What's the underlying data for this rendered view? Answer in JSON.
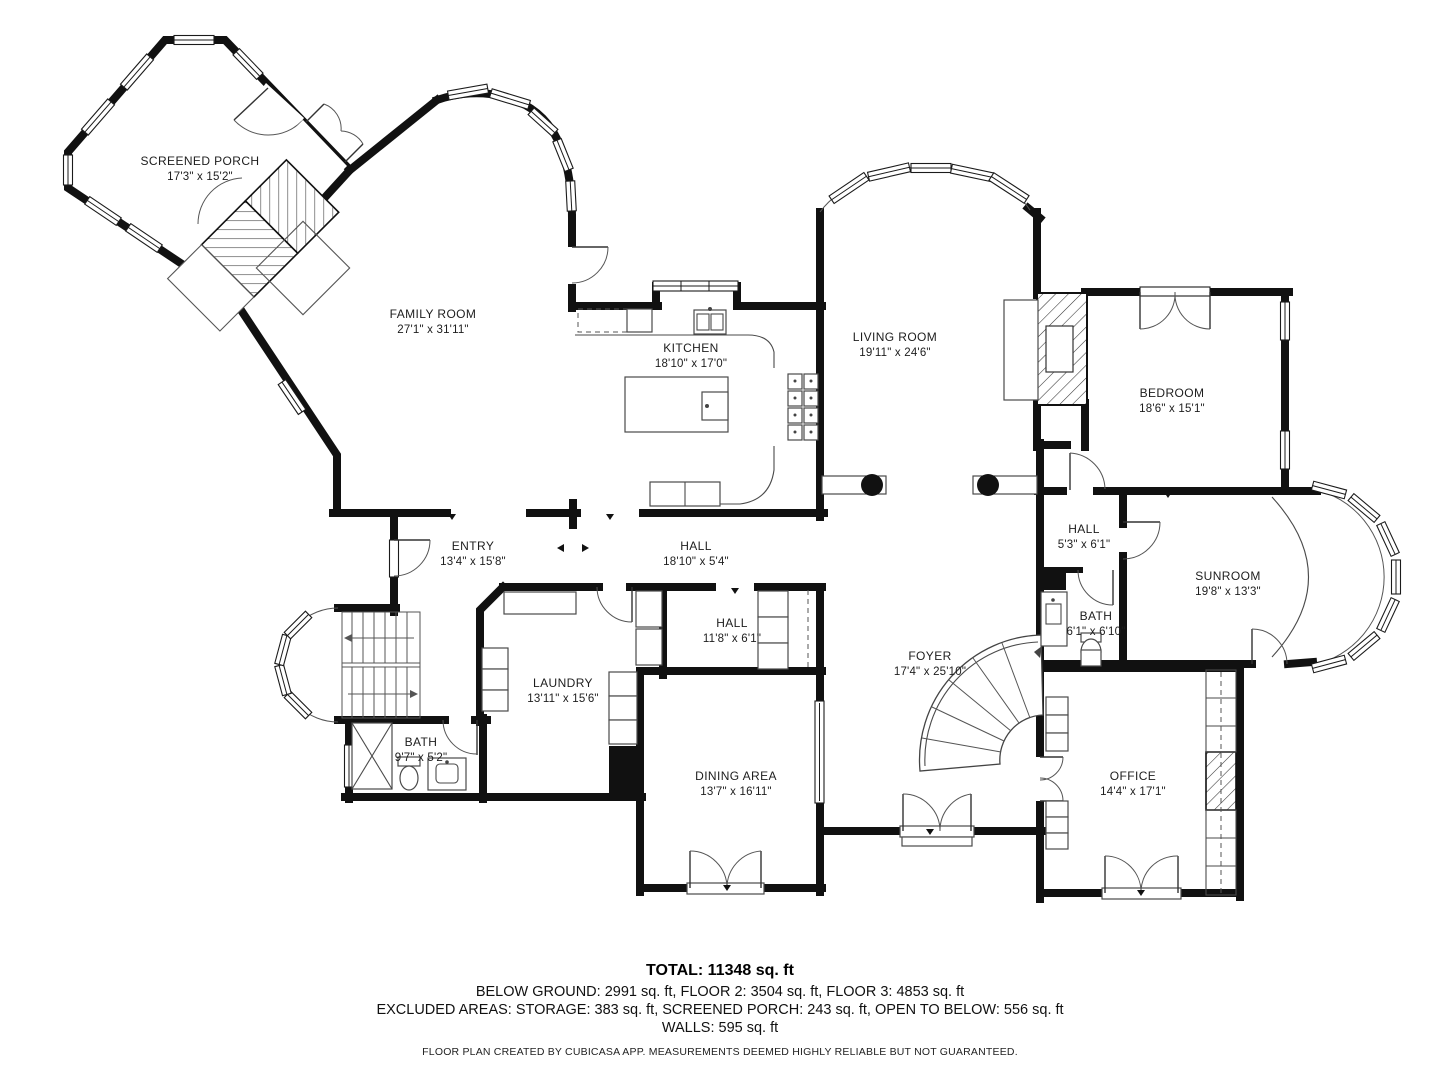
{
  "rooms": [
    {
      "name": "SCREENED PORCH",
      "dims": "17'3\" x 15'2\""
    },
    {
      "name": "FAMILY ROOM",
      "dims": "27'1\" x 31'11\""
    },
    {
      "name": "KITCHEN",
      "dims": "18'10\" x 17'0\""
    },
    {
      "name": "LIVING ROOM",
      "dims": "19'11\" x 24'6\""
    },
    {
      "name": "BEDROOM",
      "dims": "18'6\" x 15'1\""
    },
    {
      "name": "ENTRY",
      "dims": "13'4\" x 15'8\""
    },
    {
      "name": "HALL",
      "dims": "18'10\" x 5'4\""
    },
    {
      "name": "HALL",
      "dims": "5'3\" x 6'1\""
    },
    {
      "name": "SUNROOM",
      "dims": "19'8\" x 13'3\""
    },
    {
      "name": "BATH",
      "dims": "6'1\" x 6'10\""
    },
    {
      "name": "HALL",
      "dims": "11'8\" x 6'1\""
    },
    {
      "name": "LAUNDRY",
      "dims": "13'11\" x 15'6\""
    },
    {
      "name": "FOYER",
      "dims": "17'4\" x 25'10\""
    },
    {
      "name": "BATH",
      "dims": "9'7\" x 5'2\""
    },
    {
      "name": "DINING AREA",
      "dims": "13'7\" x 16'11\""
    },
    {
      "name": "OFFICE",
      "dims": "14'4\" x 17'1\""
    }
  ],
  "footer": {
    "total": "TOTAL: 11348 sq. ft",
    "floors": "BELOW GROUND: 2991 sq. ft, FLOOR 2: 3504 sq. ft, FLOOR 3: 4853 sq. ft",
    "excluded": "EXCLUDED AREAS: STORAGE: 383 sq. ft, SCREENED PORCH: 243 sq. ft, OPEN TO BELOW: 556 sq. ft",
    "walls": "WALLS: 595 sq. ft",
    "credit": "FLOOR PLAN CREATED BY CUBICASA APP. MEASUREMENTS DEEMED HIGHLY RELIABLE BUT NOT GUARANTEED."
  },
  "colors": {
    "wall": "#111111",
    "line": "#4a4a4a",
    "text": "#1f1f1f",
    "background": "#ffffff"
  }
}
